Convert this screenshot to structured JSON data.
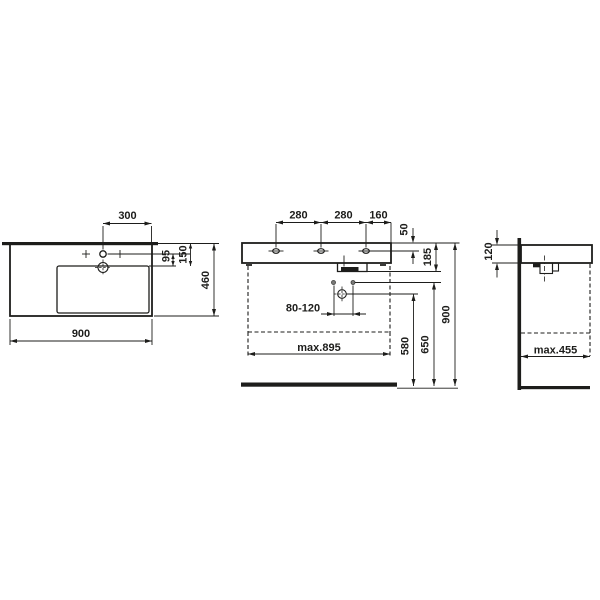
{
  "drawing": {
    "type": "washbasin-technical-dimension-drawing",
    "line_color": "#1d1d1b",
    "background_color": "#ffffff"
  },
  "views": {
    "top": {
      "tap_to_right_edge": "300",
      "overall_width": "900",
      "overall_depth": "460",
      "tap_line_to_bowl_edge": "95",
      "rear_to_bowl_edge": "150"
    },
    "front": {
      "hole_pitch_left": "280",
      "hole_pitch_right": "280",
      "hole_to_edge": "160",
      "rim_to_holes": "50",
      "rim_to_trap": "185",
      "supply_spacing": "80-120",
      "max_unit_width": "max.895",
      "floor_to_waste": "580",
      "floor_to_supply": "650",
      "floor_to_rim": "900"
    },
    "side": {
      "rim_thickness": "120",
      "max_unit_depth": "max.455"
    }
  }
}
